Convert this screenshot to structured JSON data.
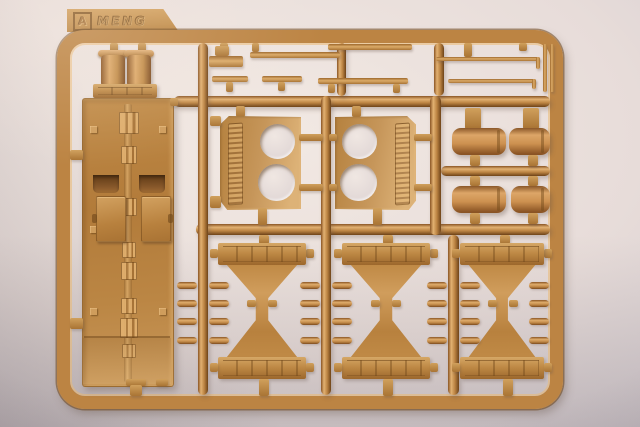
{
  "photo": {
    "type": "photograph",
    "subject": "Tan injection-molded plastic model-kit sprue (parts runner) photographed on a plain studio background",
    "sprue_tag": {
      "letter": "A",
      "brand": "MENG"
    },
    "visible_parts": [
      "large hull deck panel with twin exhaust stacks, hatches and stowage bins",
      "two engine-deck plates each with two circular fan openings",
      "four cylindrical fuel drums",
      "three hourglass-shaped hull frame parts",
      "assorted thin rods, bars and small pegs"
    ],
    "colors": {
      "plastic": "#bc8443",
      "hi": "#e2b172",
      "lo": "#8a5524",
      "deep": "#6e4318",
      "bg1": "#f2e9e3",
      "bg2": "#c3bbc0"
    }
  }
}
